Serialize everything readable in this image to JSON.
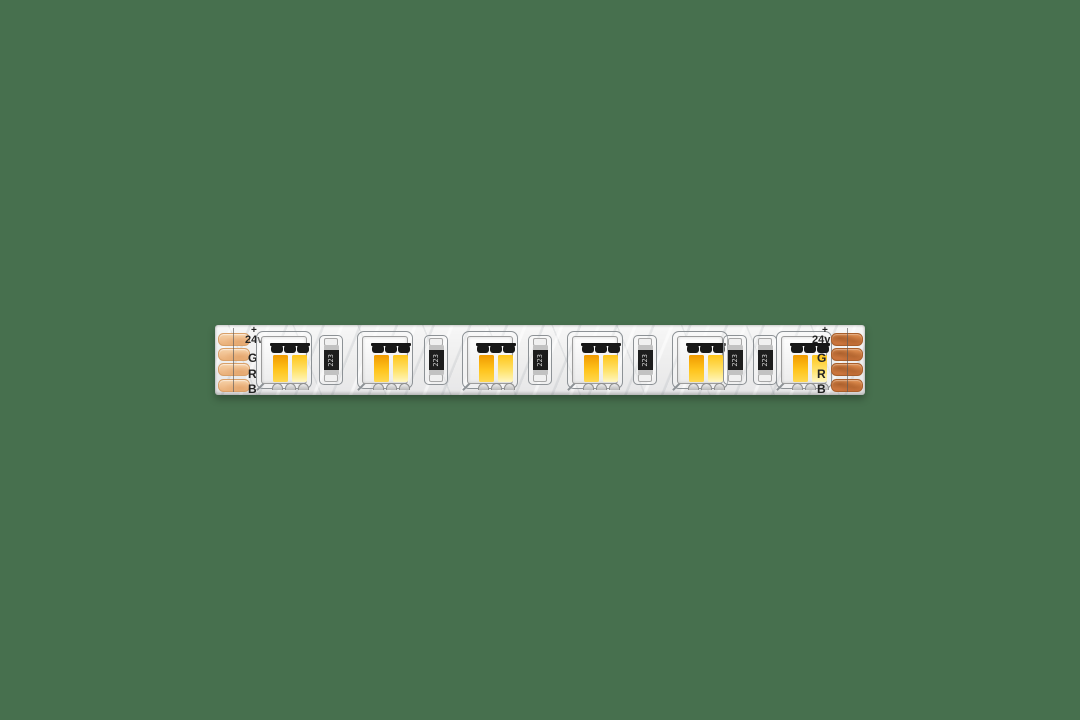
{
  "scene": {
    "background_color": "#47704e",
    "subject": "white flexible LED strip segment with dual-color SMD LEDs"
  },
  "strip": {
    "pcb_color": "#efefef",
    "led_count": 6,
    "resistor_marking": "223",
    "led_colors": {
      "warm_die_top": "#f09a00",
      "warm_die_bottom": "#ffd84f",
      "cool_die_top": "#ffc51a",
      "cool_die_bottom": "#fff6c0"
    },
    "connectors": {
      "left": {
        "pad_color": "#eab079",
        "labels": {
          "plus": "+",
          "voltage": "24v",
          "g": "G",
          "r": "R",
          "b": "B"
        }
      },
      "right": {
        "pad_color": "#c8713a",
        "labels": {
          "plus": "+",
          "voltage": "24v",
          "g": "G",
          "r": "R",
          "b": "B"
        }
      }
    }
  }
}
